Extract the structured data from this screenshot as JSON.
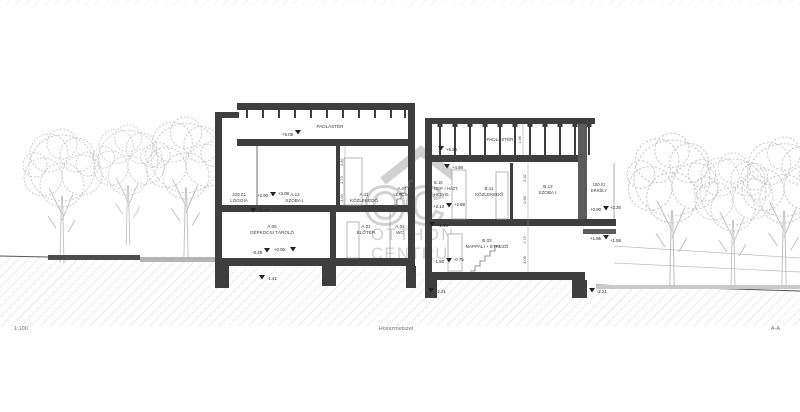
{
  "sheet": {
    "scale": "1:100",
    "title": "Hosszmetszet",
    "section_ref": "A-A"
  },
  "watermark": {
    "monogram": "OC",
    "name_line1": "OTTHON",
    "name_line2": "CENTRUM"
  },
  "left_block": {
    "attic_label": "PADLÁSTÉR",
    "upper_rooms": [
      {
        "id": "100.01",
        "name": "LOGGIA"
      },
      {
        "id": "A.12",
        "name": "SZOBA I."
      },
      {
        "id": "A.11",
        "name": "KÖZLEKEDŐ"
      },
      {
        "id": "A.07",
        "name": "LÉPCSŐ"
      }
    ],
    "ground_rooms": [
      {
        "id": "A.06",
        "name": "GÉPKOCSI TÁROLÓ"
      },
      {
        "id": "A.01",
        "name": "ELŐTÉR"
      },
      {
        "id": "A.04",
        "name": "WC"
      }
    ],
    "levels": {
      "attic_top": "+5.08",
      "upper_a": "+2.90",
      "upper_b": "+3.08",
      "upper_c": "+2.70",
      "ground_a": "-0.29",
      "ground_b": "+0.06",
      "foundation": "-1.41"
    },
    "dims": [
      "2.87",
      "2.70",
      "3.04"
    ]
  },
  "right_block": {
    "attic_label": "PADLÁSTÉR",
    "upper_rooms": [
      {
        "id": "B.15",
        "name_1": "GÉP. / HÁZT.",
        "name_2": "HELYIS."
      },
      {
        "id": "B.11",
        "name": "KÖZLEKEDŐ"
      },
      {
        "id": "B.12",
        "name": "SZOBA I."
      },
      {
        "id": "100.01",
        "name": "ERKÉLY"
      }
    ],
    "ground_rooms": [
      {
        "id": "B.03",
        "name": "NAPPALI + ÉTKEZŐ"
      }
    ],
    "levels": {
      "attic_top": "+5.34",
      "attic_bottom": "+4.98",
      "upper_a": "+2.13",
      "upper_b": "+2.98",
      "upper_c": "+1.95",
      "ground_a": "-1.50",
      "ground_b": "-0.75",
      "foundation_left": "-2.21",
      "balcony_a": "+0.90",
      "balcony_b": "+2.26",
      "balcony_c": "+1.85",
      "balcony_d": "+1.58",
      "foundation_right": "-2.21"
    },
    "dims": [
      "1.98",
      "2.02",
      "2.96",
      "1.70",
      "3.05"
    ]
  }
}
